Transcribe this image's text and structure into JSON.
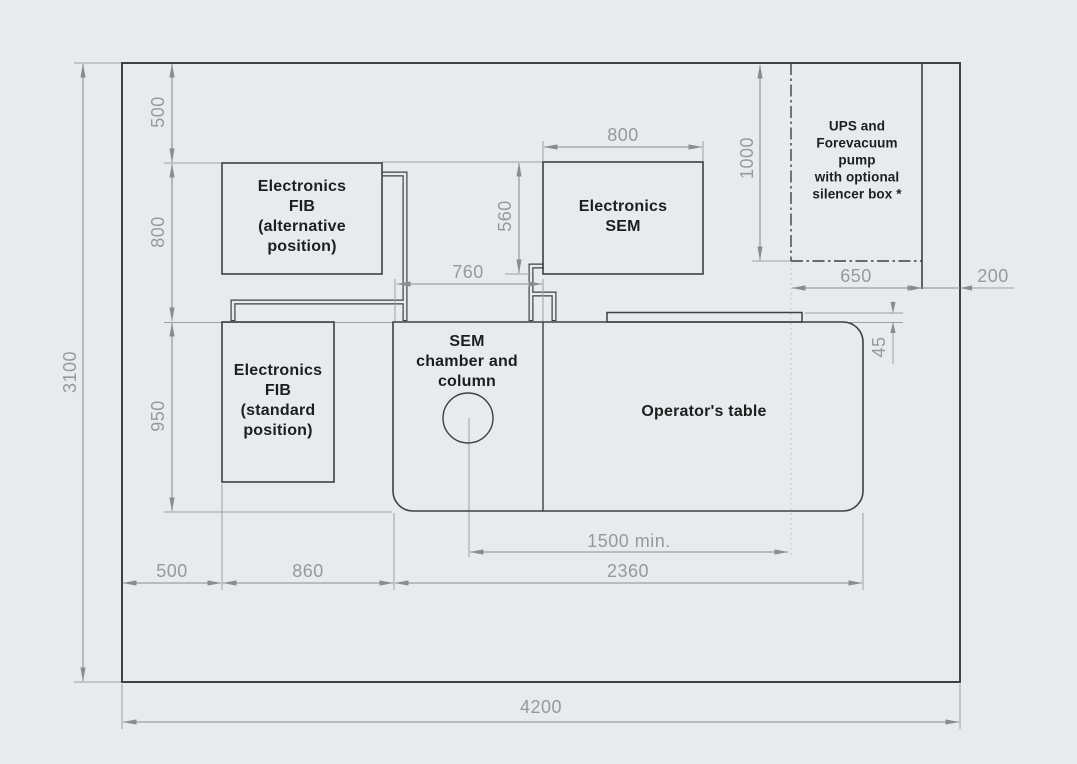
{
  "drawing": {
    "labels": {
      "fib_alternative": "Electronics\nFIB\n(alternative\nposition)",
      "fib_standard": "Electronics\nFIB\n(standard\nposition)",
      "sem_electronics": "Electronics\nSEM",
      "sem_chamber": "SEM\nchamber and\ncolumn",
      "operators_table": "Operator's table",
      "ups": "UPS and\nForevacuum\npump\nwith optional\nsilencer box *"
    },
    "dimensions": {
      "room_height": "3100",
      "top_offset": "500",
      "fib_alt_drop": "800",
      "fib_std_drop": "950",
      "sem_width": "800",
      "sem_depth": "560",
      "chamber_width": "760",
      "ups_height": "1000",
      "ups_width": "650",
      "right_gap": "200",
      "shelf_depth": "45",
      "left_gap": "500",
      "fib_zone_width": "860",
      "table_width": "2360",
      "workspace_min": "1500 min.",
      "room_width": "4200"
    },
    "colors": {
      "background": "#e7ebee",
      "object_line": "#3b4144",
      "dimension_line": "#8a9296",
      "dimension_text": "#939a9e",
      "label_text": "#1d1e1e"
    }
  }
}
